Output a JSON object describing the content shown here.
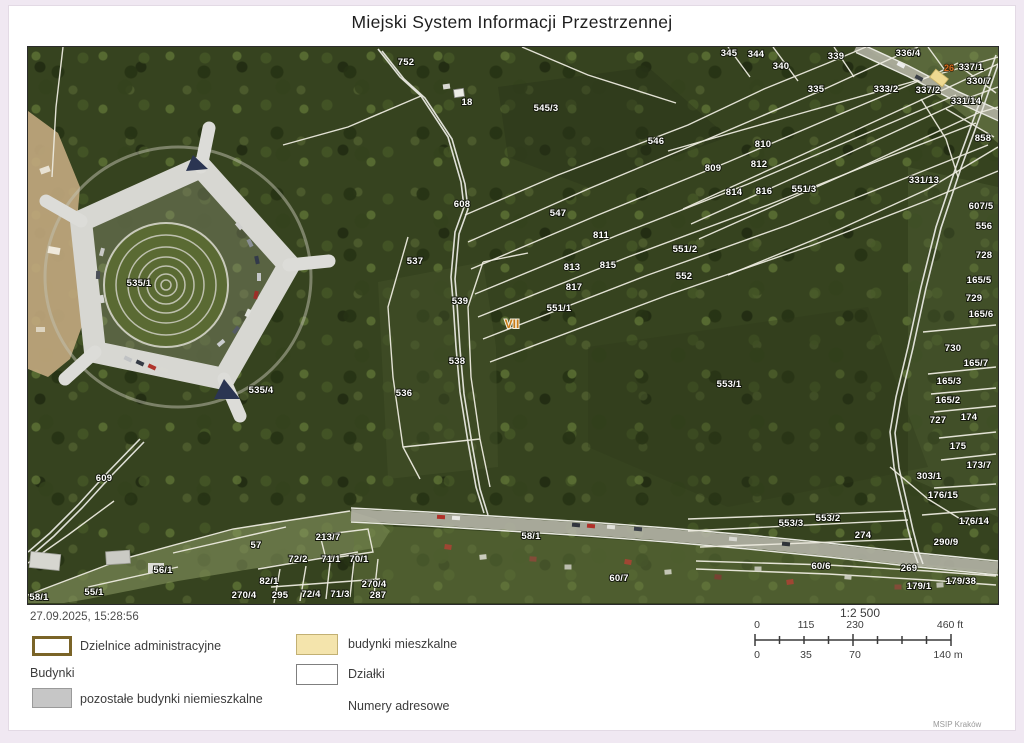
{
  "page": {
    "title": "Miejski System Informacji Przestrzennej",
    "timestamp": "27.09.2025, 15:28:56",
    "credit": "MSIP Kraków"
  },
  "legend": {
    "districts_label": "Dzielnice administracyjne",
    "buildings_header": "Budynki",
    "nonresidential_label": "pozostałe budynki niemieszkalne",
    "residential_label": "budynki mieszkalne",
    "parcels_label": "Działki",
    "addresses_label": "Numery adresowe",
    "colors": {
      "district_border": "#7a6428",
      "residential_fill": "#f4e4ac",
      "nonresidential_fill": "#c6c6c6",
      "parcel_border": "#7f7f7f",
      "forest": "#36431f",
      "boundary_line": "#eceade"
    }
  },
  "scalebar": {
    "ratio": "1:2 500",
    "ft_ticks": [
      "0",
      "115",
      "230",
      "460 ft"
    ],
    "m_ticks": [
      "0",
      "35",
      "70",
      "140 m"
    ]
  },
  "map": {
    "district_label": {
      "t": "VII",
      "x": 484,
      "y": 281
    },
    "address_label": {
      "t": "26",
      "x": 921,
      "y": 24
    },
    "labels": [
      {
        "t": "752",
        "x": 378,
        "y": 18
      },
      {
        "t": "18",
        "x": 439,
        "y": 58
      },
      {
        "t": "545/3",
        "x": 518,
        "y": 64
      },
      {
        "t": "546",
        "x": 628,
        "y": 97
      },
      {
        "t": "345",
        "x": 701,
        "y": 9
      },
      {
        "t": "344",
        "x": 728,
        "y": 10
      },
      {
        "t": "340",
        "x": 753,
        "y": 22
      },
      {
        "t": "339",
        "x": 808,
        "y": 12
      },
      {
        "t": "336/4",
        "x": 880,
        "y": 9
      },
      {
        "t": "337/1",
        "x": 943,
        "y": 23
      },
      {
        "t": "335",
        "x": 788,
        "y": 45
      },
      {
        "t": "333/2",
        "x": 858,
        "y": 45
      },
      {
        "t": "337/2",
        "x": 900,
        "y": 46
      },
      {
        "t": "330/7",
        "x": 951,
        "y": 37
      },
      {
        "t": "331/14",
        "x": 938,
        "y": 57
      },
      {
        "t": "858",
        "x": 955,
        "y": 94
      },
      {
        "t": "331/13",
        "x": 896,
        "y": 136
      },
      {
        "t": "810",
        "x": 735,
        "y": 100
      },
      {
        "t": "809",
        "x": 685,
        "y": 124
      },
      {
        "t": "812",
        "x": 731,
        "y": 120
      },
      {
        "t": "814",
        "x": 706,
        "y": 148
      },
      {
        "t": "816",
        "x": 736,
        "y": 147
      },
      {
        "t": "551/3",
        "x": 776,
        "y": 145
      },
      {
        "t": "608",
        "x": 434,
        "y": 160
      },
      {
        "t": "547",
        "x": 530,
        "y": 169
      },
      {
        "t": "537",
        "x": 387,
        "y": 217
      },
      {
        "t": "811",
        "x": 573,
        "y": 191
      },
      {
        "t": "813",
        "x": 544,
        "y": 223
      },
      {
        "t": "815",
        "x": 580,
        "y": 221
      },
      {
        "t": "551/2",
        "x": 657,
        "y": 205
      },
      {
        "t": "552",
        "x": 656,
        "y": 232
      },
      {
        "t": "817",
        "x": 546,
        "y": 243
      },
      {
        "t": "551/1",
        "x": 531,
        "y": 264
      },
      {
        "t": "539",
        "x": 432,
        "y": 257
      },
      {
        "t": "538",
        "x": 429,
        "y": 317
      },
      {
        "t": "536",
        "x": 376,
        "y": 349
      },
      {
        "t": "535/1",
        "x": 111,
        "y": 239
      },
      {
        "t": "535/4",
        "x": 233,
        "y": 346
      },
      {
        "t": "609",
        "x": 76,
        "y": 434
      },
      {
        "t": "607/5",
        "x": 953,
        "y": 162
      },
      {
        "t": "556",
        "x": 956,
        "y": 182
      },
      {
        "t": "728",
        "x": 956,
        "y": 211
      },
      {
        "t": "165/5",
        "x": 951,
        "y": 236
      },
      {
        "t": "729",
        "x": 946,
        "y": 254
      },
      {
        "t": "165/6",
        "x": 953,
        "y": 270
      },
      {
        "t": "730",
        "x": 925,
        "y": 304
      },
      {
        "t": "165/7",
        "x": 948,
        "y": 319
      },
      {
        "t": "165/3",
        "x": 921,
        "y": 337
      },
      {
        "t": "165/2",
        "x": 920,
        "y": 356
      },
      {
        "t": "727",
        "x": 910,
        "y": 376
      },
      {
        "t": "174",
        "x": 941,
        "y": 373
      },
      {
        "t": "175",
        "x": 930,
        "y": 402
      },
      {
        "t": "173/7",
        "x": 951,
        "y": 421
      },
      {
        "t": "303/1",
        "x": 901,
        "y": 432
      },
      {
        "t": "176/15",
        "x": 915,
        "y": 451
      },
      {
        "t": "176/14",
        "x": 946,
        "y": 477
      },
      {
        "t": "290/9",
        "x": 918,
        "y": 498
      },
      {
        "t": "269",
        "x": 881,
        "y": 524
      },
      {
        "t": "179/1",
        "x": 891,
        "y": 542
      },
      {
        "t": "179/38",
        "x": 933,
        "y": 537
      },
      {
        "t": "553/1",
        "x": 701,
        "y": 340
      },
      {
        "t": "553/3",
        "x": 763,
        "y": 479
      },
      {
        "t": "553/2",
        "x": 800,
        "y": 474
      },
      {
        "t": "274",
        "x": 835,
        "y": 491
      },
      {
        "t": "60/6",
        "x": 793,
        "y": 522
      },
      {
        "t": "60/7",
        "x": 591,
        "y": 534
      },
      {
        "t": "58/1",
        "x": 503,
        "y": 492
      },
      {
        "t": "57",
        "x": 228,
        "y": 501
      },
      {
        "t": "56/1",
        "x": 135,
        "y": 526
      },
      {
        "t": "55/1",
        "x": 66,
        "y": 548
      },
      {
        "t": "58/1",
        "x": 11,
        "y": 553
      },
      {
        "t": "82/1",
        "x": 241,
        "y": 537
      },
      {
        "t": "213/7",
        "x": 300,
        "y": 493
      },
      {
        "t": "72/2",
        "x": 270,
        "y": 515
      },
      {
        "t": "71/1",
        "x": 303,
        "y": 515
      },
      {
        "t": "70/1",
        "x": 331,
        "y": 515
      },
      {
        "t": "270/4",
        "x": 216,
        "y": 551
      },
      {
        "t": "295",
        "x": 252,
        "y": 551
      },
      {
        "t": "72/4",
        "x": 283,
        "y": 550
      },
      {
        "t": "71/3",
        "x": 312,
        "y": 550
      },
      {
        "t": "287",
        "x": 350,
        "y": 551
      },
      {
        "t": "270/4",
        "x": 346,
        "y": 540
      }
    ]
  }
}
